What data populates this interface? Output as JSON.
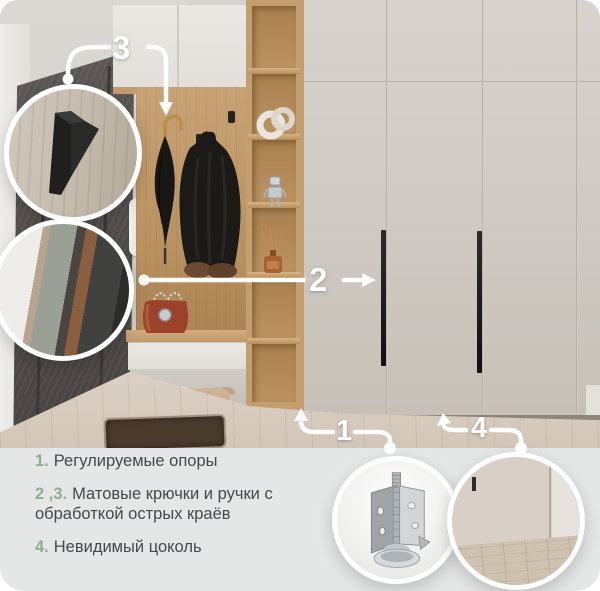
{
  "callouts": {
    "c1": "1",
    "c2": "2",
    "c3": "3",
    "c4": "4"
  },
  "legend": {
    "items": [
      {
        "num": "1.",
        "text": "Регулируемые опоры"
      },
      {
        "num": "2 ,3.",
        "text": "Матовые крючки и ручки с обработкой острых краёв"
      },
      {
        "num": "4.",
        "text": "Невидимый цоколь"
      }
    ]
  },
  "insets": {
    "hook": "matte-black-hook-closeup",
    "handle": "matte-handle-closeup",
    "foot": "adjustable-support-closeup",
    "plinth": "invisible-plinth-closeup"
  },
  "colors": {
    "accent_green": "#8fac93",
    "footer_bg": "#e5e7e6",
    "text": "#45484a",
    "callout": "#ffffff"
  }
}
